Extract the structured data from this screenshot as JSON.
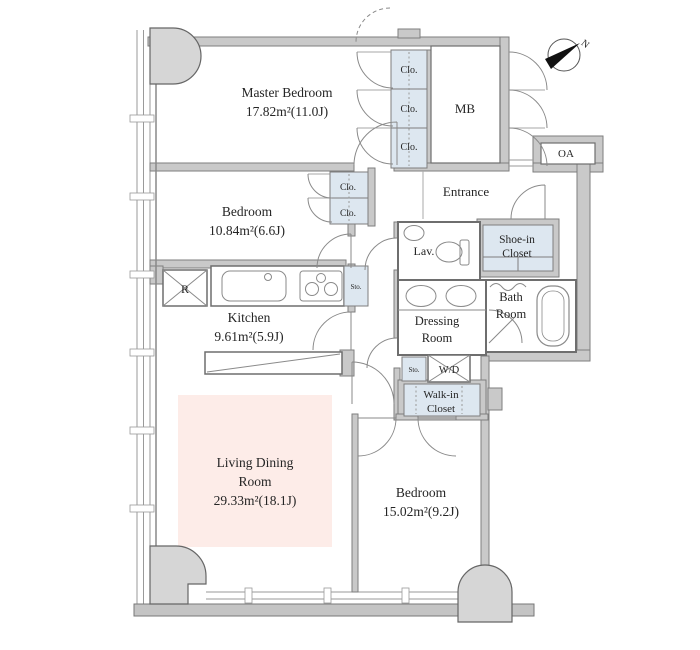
{
  "floor_plan": {
    "compass_label": "N",
    "rooms": {
      "master_bedroom": {
        "name": "Master Bedroom",
        "area": "17.82m²(11.0J)"
      },
      "bedroom_2": {
        "name": "Bedroom",
        "area": "10.84m²(6.6J)"
      },
      "kitchen": {
        "name": "Kitchen",
        "area": "9.61m²(5.9J)"
      },
      "living_dining_room": {
        "name_line1": "Living Dining",
        "name_line2": "Room",
        "area": "29.33m²(18.1J)"
      },
      "bedroom_3": {
        "name": "Bedroom",
        "area": "15.02m²(9.2J)"
      },
      "entrance": {
        "name": "Entrance"
      },
      "lavatory": {
        "name": "Lav."
      },
      "bath_room": {
        "name_line1": "Bath",
        "name_line2": "Room"
      },
      "dressing_room": {
        "name_line1": "Dressing",
        "name_line2": "Room"
      },
      "shoe_in_closet": {
        "name_line1": "Shoe-in",
        "name_line2": "Closet"
      },
      "walk_in_closet": {
        "name_line1": "Walk-in",
        "name_line2": "Closet"
      },
      "washer_dryer": {
        "name": "W/D"
      },
      "meter_box": {
        "name": "MB"
      },
      "outdoor_air_unit": {
        "name": "OA"
      }
    },
    "fixtures": {
      "closet_abbreviation": "Clo.",
      "storage_abbreviation": "Sto.",
      "refrigerator_abbreviation": "R"
    },
    "colors": {
      "closet_fill": "#dde7f0",
      "living_dining_fill": "#fdece8",
      "wall_fill": "#c9c9c9",
      "pillar_fill": "#d6d6d6"
    }
  }
}
